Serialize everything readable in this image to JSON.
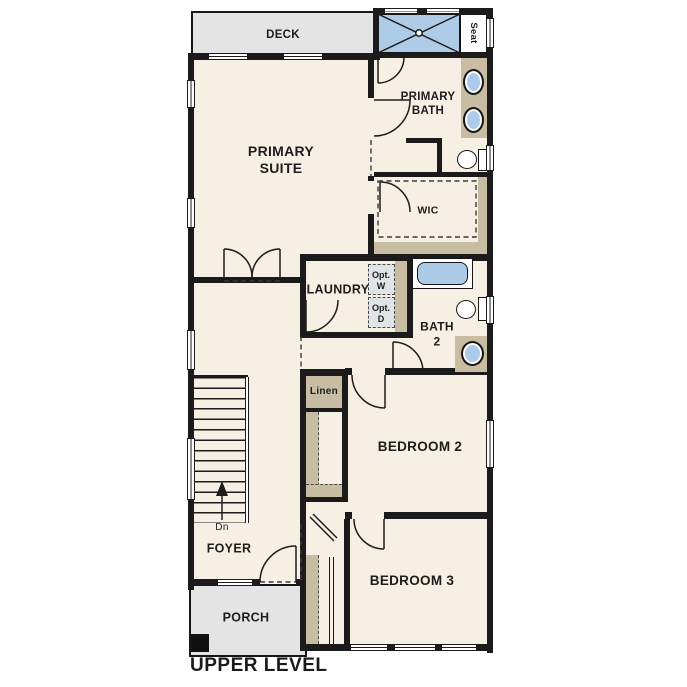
{
  "title": "UPPER LEVEL",
  "colors": {
    "wall": "#1b1b1b",
    "room_fill": "#f6f0e4",
    "cabinet_tan": "#c8bca3",
    "fixture_blue": "#abcbe9",
    "shower_blue": "#aecbe8",
    "deck_porch_gray": "#e4e4e4",
    "optional_appliance_gray": "#dfe4e7"
  },
  "labels": {
    "deck": "DECK",
    "seat": "Seat",
    "primary_bath": "PRIMARY\nBATH",
    "primary_suite": "PRIMARY\nSUITE",
    "wic": "WIC",
    "laundry": "LAUNDRY",
    "opt_washer": "Opt.\nW",
    "opt_dryer": "Opt.\nD",
    "bath2": "BATH\n2",
    "linen": "Linen",
    "bedroom2": "BEDROOM 2",
    "bedroom3": "BEDROOM 3",
    "foyer": "FOYER",
    "stairs_direction": "Dn",
    "porch": "PORCH"
  },
  "icons": {
    "shower-x-icon": "crossed diagonals with center drain",
    "stairs-down-arrow-icon": "vertical arrow pointing up with Dn text",
    "door-swing-icon": "quarter-circle arc",
    "sink-icon": "blue oval basin",
    "toilet-icon": "bowl ellipse with tank",
    "tub-icon": "blue rounded rectangle"
  }
}
